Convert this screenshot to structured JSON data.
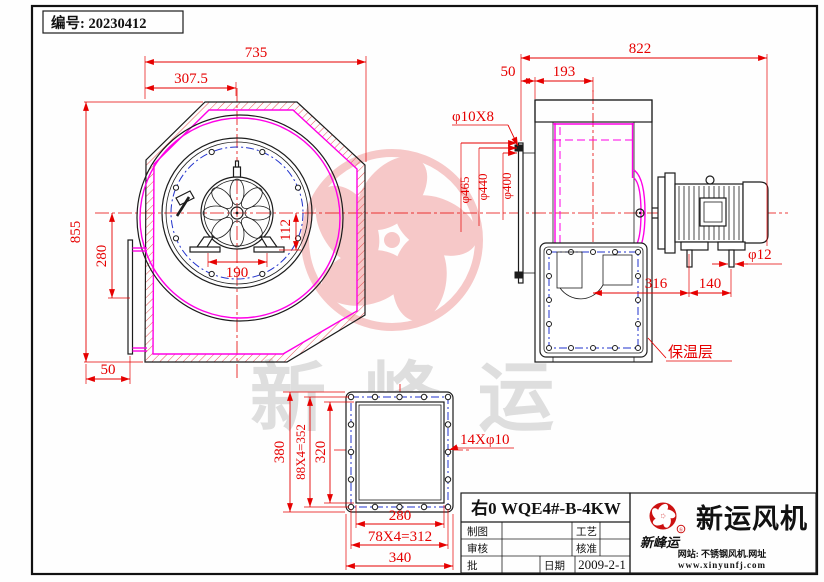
{
  "page": {
    "serial_label": "编号: 20230412"
  },
  "colors": {
    "dimension_red": "#e60000",
    "casing_magenta": "#ff00e6",
    "bolt_blue": "#2233cc",
    "outline_black": "#1c1c1c",
    "hatch_red": "#e25555",
    "watermark_pink": "#f6c8c8",
    "watermark_gray": "#dedede",
    "brand_red": "#cc1111"
  },
  "front_view": {
    "dims": {
      "total_width": "735",
      "partial_width": "307.5",
      "total_height": "855",
      "inlet_height": "280",
      "bottom_offset": "50",
      "foot_span": "190",
      "foot_height": "112"
    }
  },
  "side_view": {
    "dims": {
      "total_depth": "822",
      "flange_offset": "50",
      "inlet_depth": "193",
      "inlet_bolts": "φ10X8",
      "flange_od": "φ465",
      "bolt_circle": "φ440",
      "inlet_id": "φ400",
      "foot_bolt": "φ12",
      "motor_span": "316",
      "foot_gap": "140"
    },
    "insulation_label": "保温层"
  },
  "outlet_flange_view": {
    "dims": {
      "outer_height": "380",
      "bolt_pitch_v": "88X4=352",
      "inner_height": "320",
      "inner_width": "280",
      "bolt_pitch_h": "78X4=312",
      "outer_width": "340",
      "bolt_note": "14Xφ10"
    }
  },
  "title_block": {
    "title": "右0 WQE4#-B-4KW",
    "drafted_label": "制图",
    "process_label": "工艺",
    "checked_label": "审核",
    "approved_label": "核准",
    "ratify_label": "批",
    "date_label": "日期",
    "date_value": "2009-2-1"
  },
  "brand": {
    "script_name": "新峰运",
    "registered_mark": "®",
    "company_name": "新运风机",
    "website_line1": "网站: 不锈钢风机.网址",
    "website_line2": "www.xinyunfj.com"
  },
  "watermark": {
    "text": "新峰运",
    "registered_mark": "R"
  }
}
